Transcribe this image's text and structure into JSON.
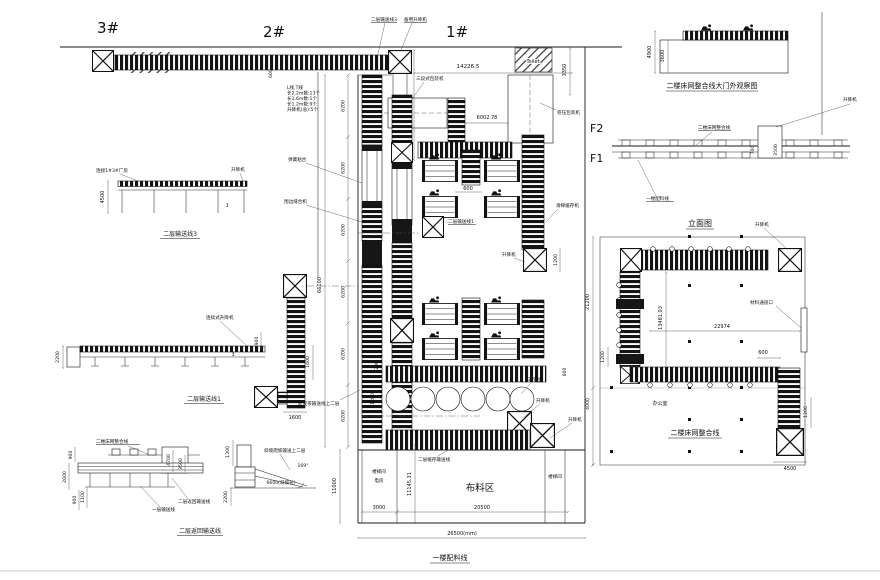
{
  "drawing": {
    "buildings": {
      "b3": "3#",
      "b2": "2#",
      "b1": "1#"
    },
    "floors": {
      "f2": "F2",
      "f1": "F1"
    },
    "notes": [
      "L线,T线",
      "长2.2m数:13个",
      "长1.6m数:1个",
      "长1.2m数:9个",
      "升降机(总):5个"
    ],
    "top": {
      "conv3": "二层输送线3",
      "backup_lift": "备用升降机",
      "toilet": "Toilet",
      "packer3": "三段式包装机",
      "rollpress": "卷压包装机",
      "d14226": "14226.5",
      "d7249": "7249.55",
      "d600": "600",
      "d6002": "6002.78",
      "d3350": "3350"
    },
    "elev1": {
      "title": "二层输送线3",
      "d4500": "4500",
      "link": "连接1#3#厂房",
      "lift": "升降机",
      "updown": "↕"
    },
    "elev2": {
      "title": "二层输送线1",
      "d2200": "2200",
      "lift": "连续式升降机",
      "d900": "900"
    },
    "strip": {
      "d1600a": "1600",
      "d1600b": "1600"
    },
    "elev3": {
      "title": "二层返回输送线",
      "net": "二楼床网整合线",
      "ret": "二层返回输送线",
      "l1": "一层输送线",
      "d900a": "900",
      "d2600": "2600",
      "d900b": "900",
      "d1100": "1100",
      "d4700": "4700",
      "d3500": "3500"
    },
    "ramp": {
      "label": "斜坡爬坡输送上二层",
      "angle": "169°",
      "d1300": "1300",
      "d2200": "2200",
      "d6600": "6600(斜坡长)"
    },
    "plan": {
      "d66100": "66100",
      "d6200": "6200",
      "d11000": "11000",
      "d11145": "11145.31",
      "d3000": "3000",
      "d20500": "20500",
      "d26500": "26500(mm)",
      "fabric": "布料区",
      "stair": "楼梯间",
      "power": "电房",
      "stair2": "楼梯间",
      "title": "一楼配料线",
      "buffer": "二层缓存输送线",
      "newbelt": "新皮带输送线上二层",
      "spring": "弹簧粘合",
      "edge": "围边缝合机",
      "conv1": "二层输送线1",
      "slide": "滑梯缓存机",
      "bench": "工作台",
      "lift": "升降机",
      "d600": "600",
      "d1200": "1200"
    },
    "gate": {
      "title": "二楼床网整合线大门外观察图",
      "d4900": "4900",
      "d3600": "3600"
    },
    "elevR": {
      "net": "二楼床网整合线",
      "lift": "升降机",
      "d700": "700",
      "d3500": "3500",
      "l1": "一楼配料线",
      "title": "立面图"
    },
    "planR": {
      "lift": "升降机",
      "door": "材料通道口",
      "office": "办公室",
      "title": "二楼床网整合线",
      "d21200": "21200",
      "d13481": "13481.03",
      "d22974": "22974",
      "d600": "600",
      "d1200": "1200",
      "d4000": "4000",
      "d4500": "4500"
    }
  }
}
